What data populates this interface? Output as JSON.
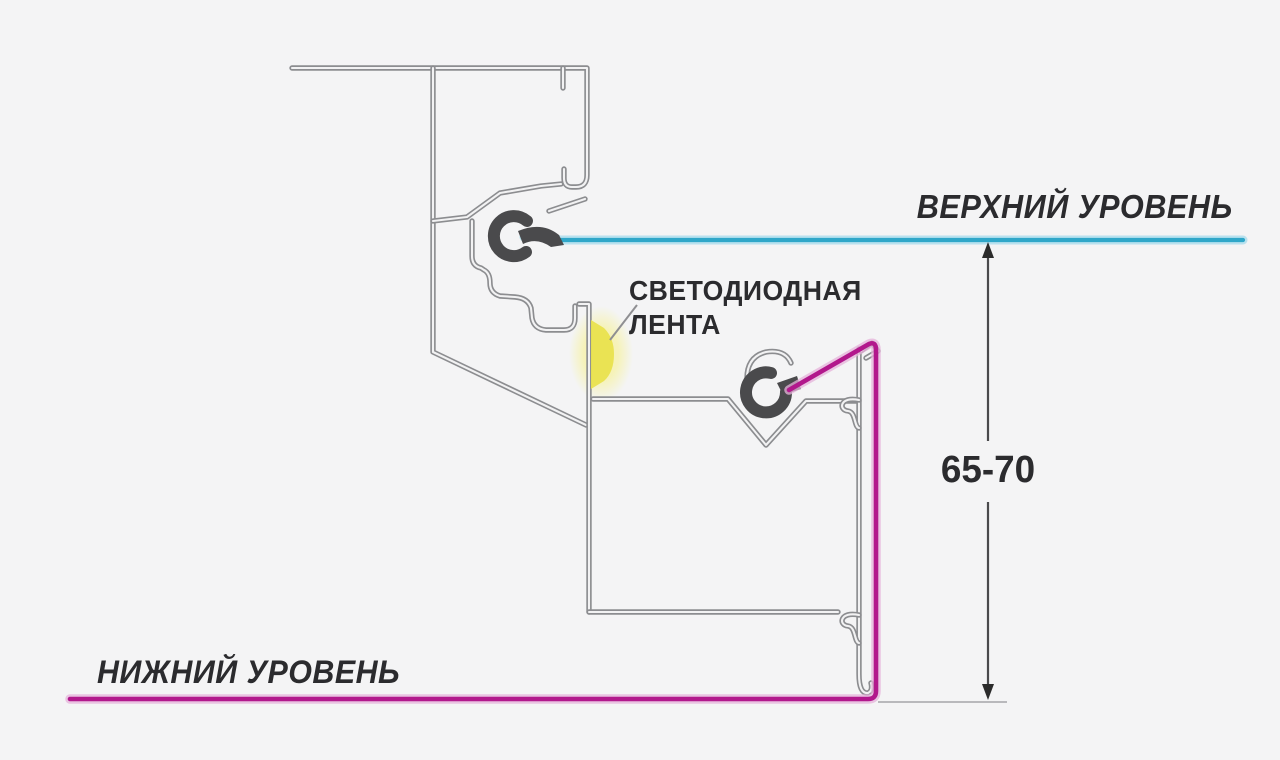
{
  "labels": {
    "upper_level": "ВЕРХНИЙ УРОВЕНЬ",
    "led_line1": "СВЕТОДИОДНАЯ",
    "led_line2": "ЛЕНТА",
    "dimension": "65-70",
    "lower_level": "НИЖНИЙ УРОВЕНЬ"
  },
  "colors": {
    "background": "#f4f4f5",
    "profile_outline": "#8c8d90",
    "clip_dark": "#4a4a4c",
    "upper_level_line": "#2fa7c9",
    "lower_level_line": "#b2188c",
    "led_glow_core": "#e8e24b",
    "led_glow_halo": "#f6f2a6",
    "dimension": "#2b2b2b",
    "text": "#2b2b2e"
  }
}
